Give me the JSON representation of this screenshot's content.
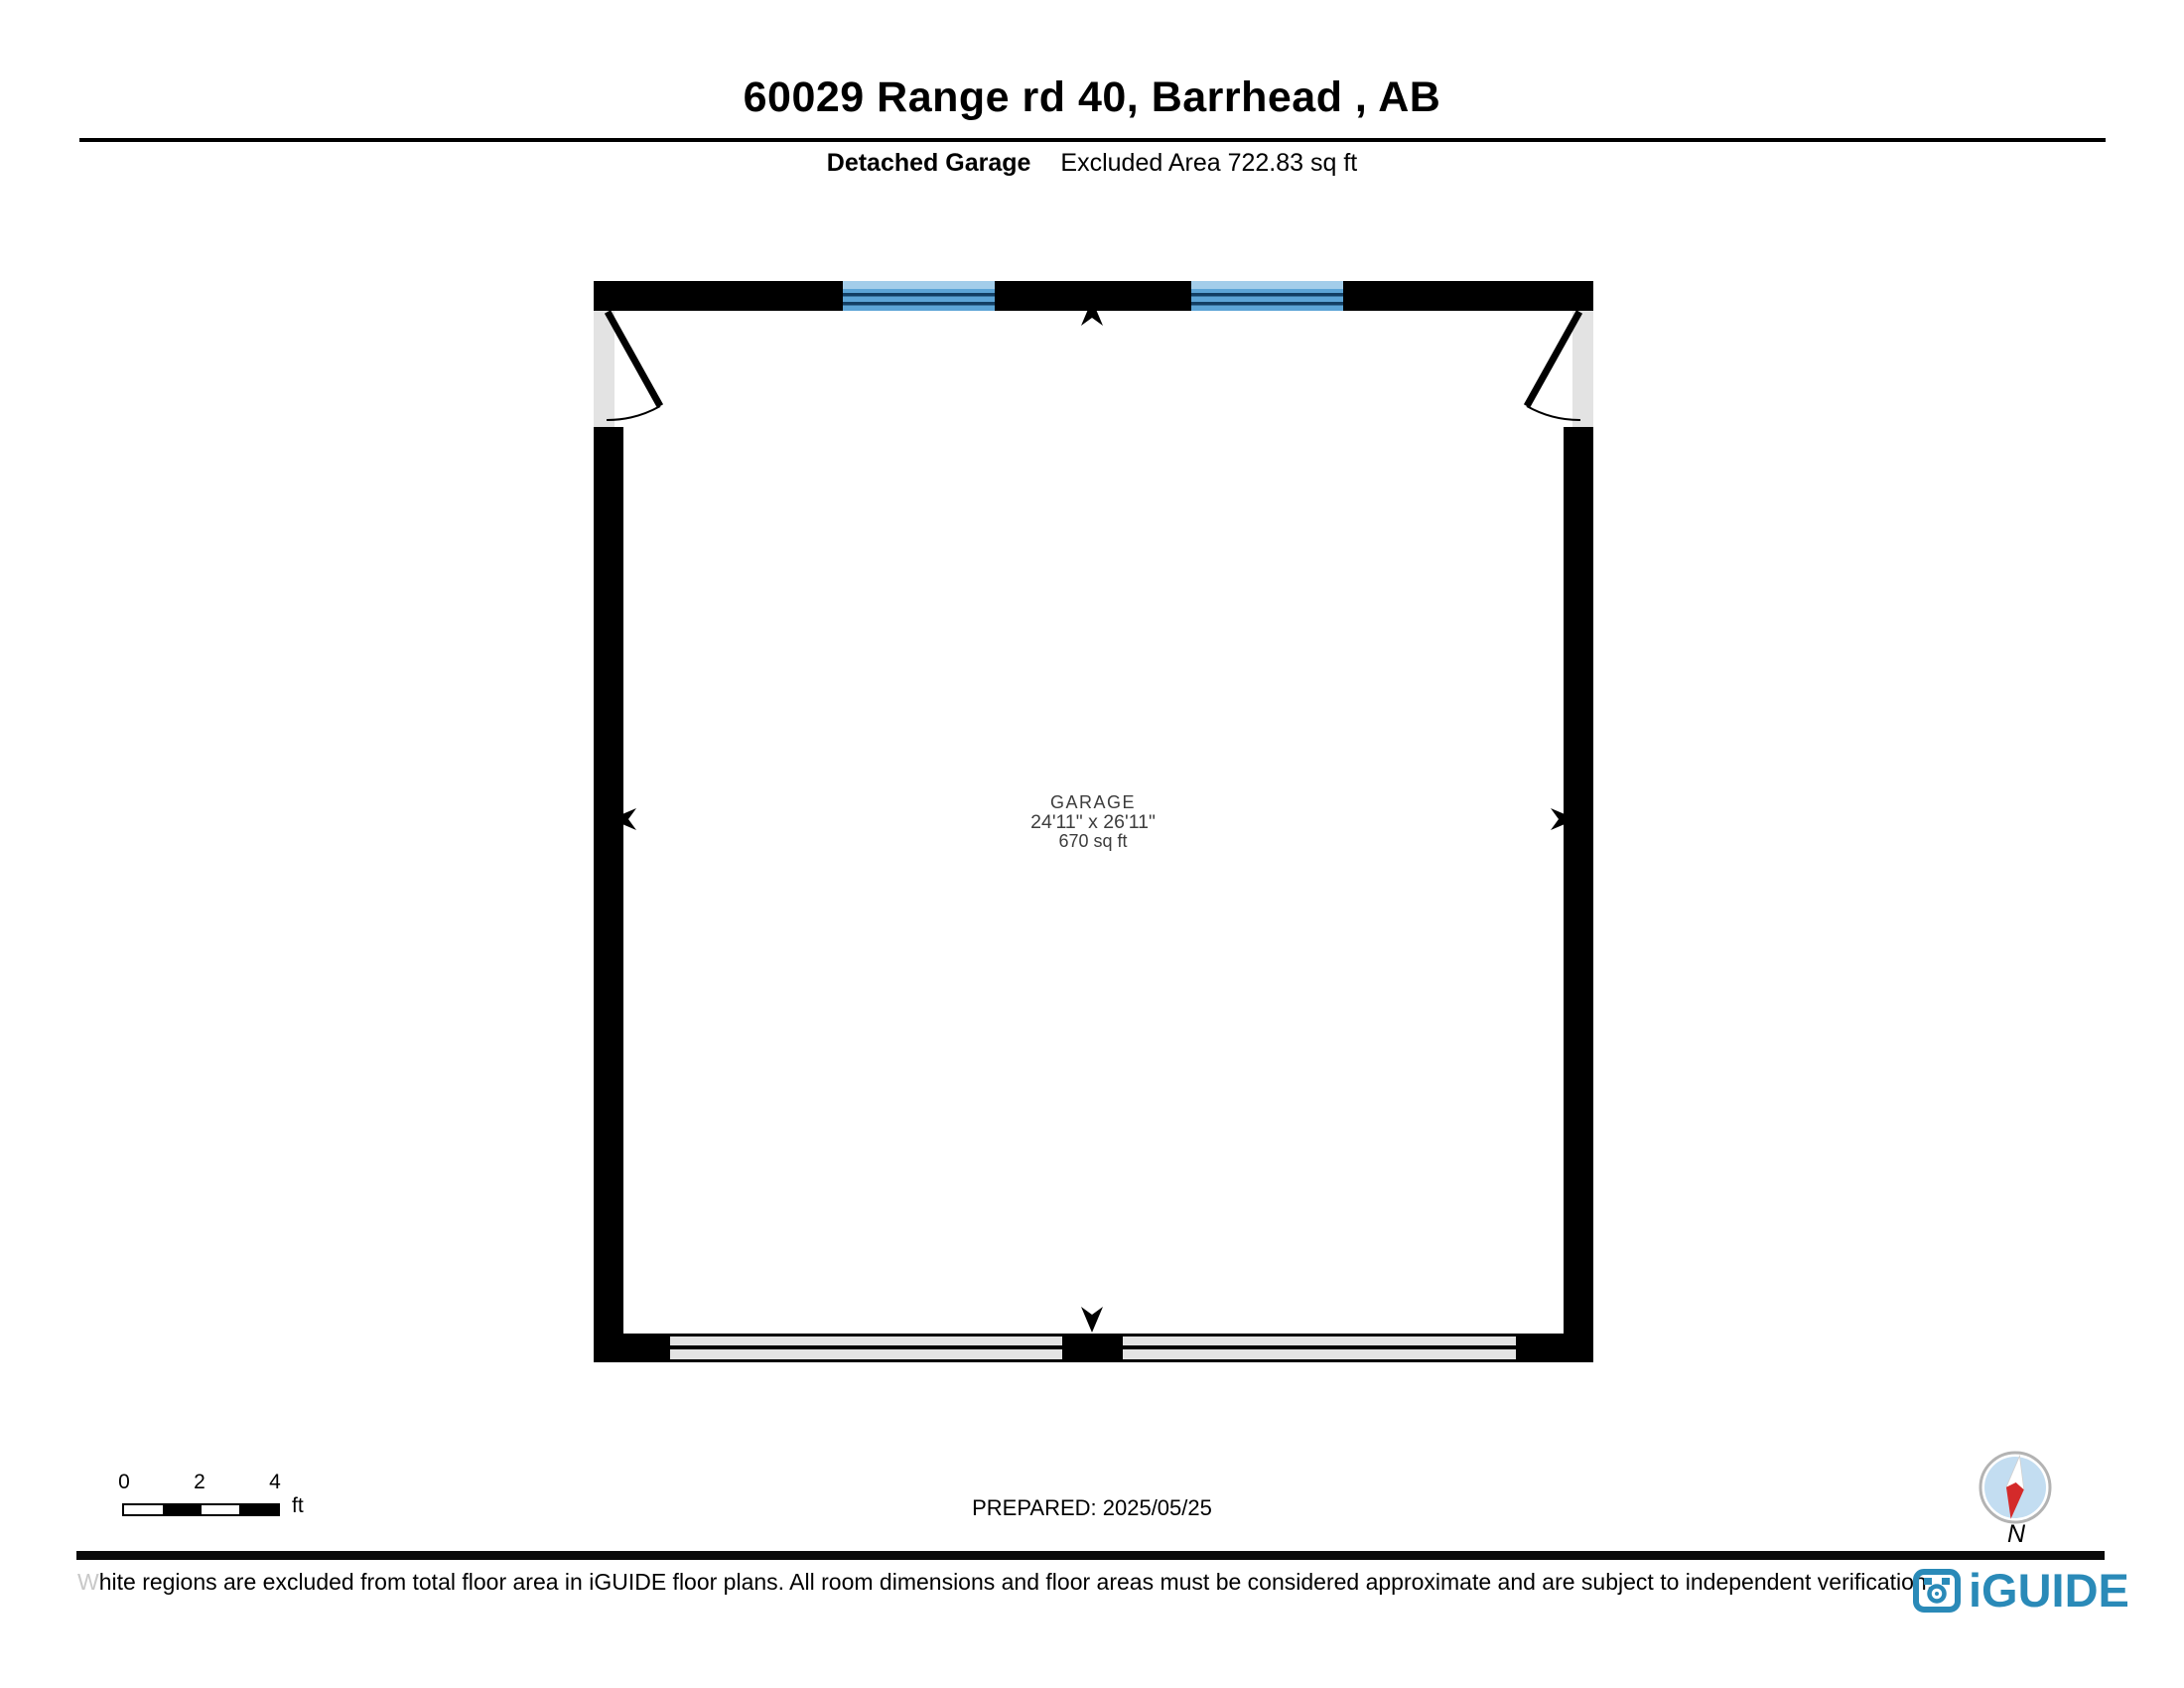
{
  "header": {
    "title": "60029 Range rd 40, Barrhead , AB",
    "floor_label": "Detached Garage",
    "excluded_area": "Excluded Area 722.83 sq ft"
  },
  "plan": {
    "room": {
      "name": "GARAGE",
      "dimensions": "24'11\" x 26'11\"",
      "area": "670 sq ft"
    }
  },
  "scale_bar": {
    "ticks": [
      "0",
      "2",
      "4"
    ],
    "unit": "ft"
  },
  "prepared": "PREPARED: 2025/05/25",
  "compass": {
    "label": "N"
  },
  "footer": {
    "disclaimer_lead": "W",
    "disclaimer_rest": "hite regions are excluded from total floor area in iGUIDE floor plans. All room dimensions and floor areas must be considered approximate and are subject to independent verification.",
    "brand": "iGUIDE"
  },
  "colors": {
    "wall_black": "#000000",
    "window_blue": "#5ca4d6",
    "window_stripe": "#a3cdea",
    "window_line": "#123e63",
    "excluded_gray": "#e3e3e3",
    "compass_blue": "#c3ddf1",
    "compass_red": "#d42a2a",
    "ring_gray": "#b3b3b3",
    "brand_blue": "#2a8ab8"
  }
}
